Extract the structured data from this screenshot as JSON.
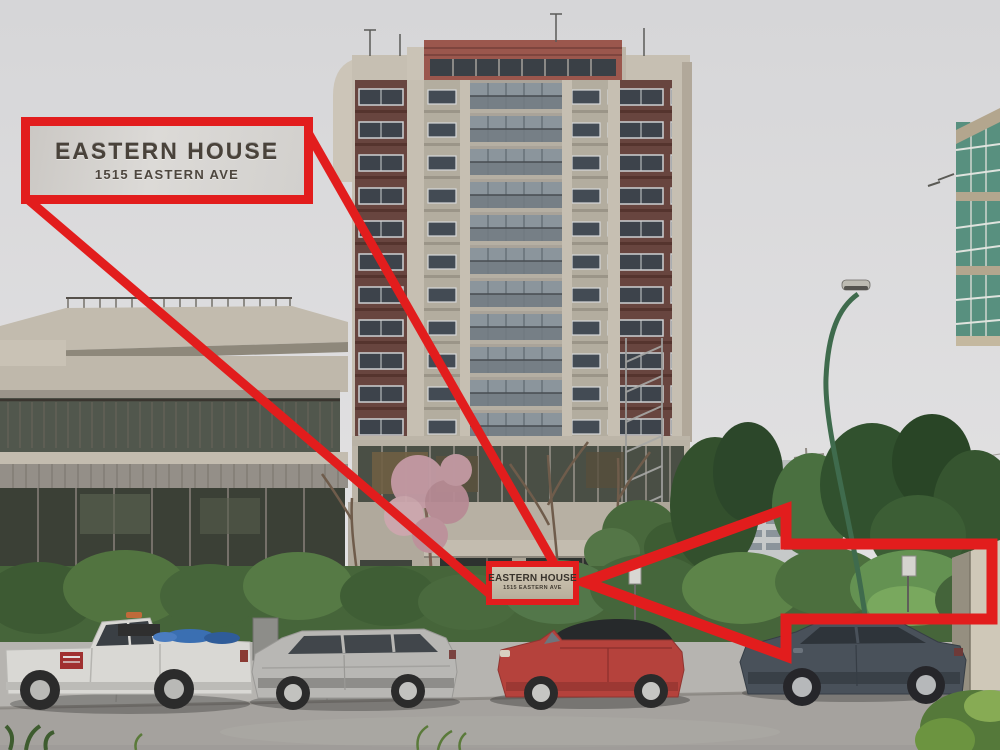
{
  "annotations": {
    "accent_color": "#e21d1d",
    "callout": {
      "title": "EASTERN HOUSE",
      "subtitle": "1515 EASTERN AVE"
    },
    "building_sign": {
      "title": "EASTERN HOUSE",
      "subtitle": "1515 EASTERN AVE"
    },
    "entrance_address": "1515"
  },
  "scene": {
    "palette": {
      "sky": "#dadadc",
      "tower_concrete": "#c6bfb2",
      "tower_panel_maroon": "#68453f",
      "hedge_green": "#46653a",
      "road_asphalt": "#a5a29e",
      "lamp_post_green": "#3f6b4d",
      "pickup_truck": "#d9d8d4",
      "station_wagon": "#b8b7b4",
      "convertible_red": "#b5423c",
      "sedan_gray": "#49515a"
    }
  }
}
